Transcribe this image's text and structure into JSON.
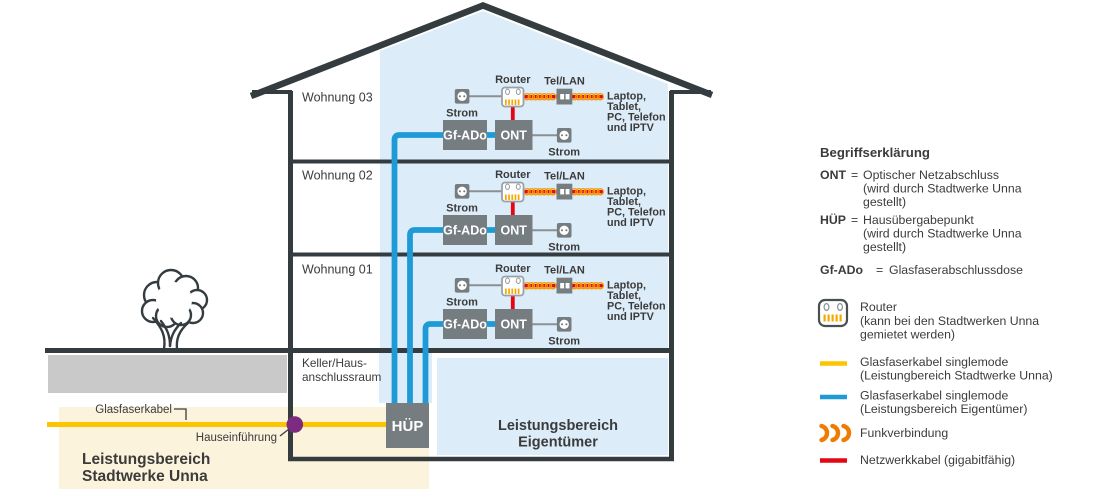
{
  "diagram": {
    "floors": [
      {
        "label": "Wohnung 03"
      },
      {
        "label": "Wohnung 02"
      },
      {
        "label": "Wohnung 01"
      }
    ],
    "basement_label_lines": [
      "Keller/Haus-",
      "anschlussraum"
    ],
    "unit": {
      "router_label": "Router",
      "tel_lan_label": "Tel/LAN",
      "strom_label": "Strom",
      "gfado_label": "Gf-ADo",
      "ont_label": "ONT",
      "device_lines": [
        "Laptop,",
        "Tablet,",
        "PC, Telefon",
        "und IPTV"
      ]
    },
    "huep_label": "HÜP",
    "glasfaserkabel_label": "Glasfaserkabel",
    "hauseinfuehrung_label": "Hauseinführung",
    "zone_stadtwerke_lines": [
      "Leistungsbereich",
      "Stadtwerke Unna"
    ],
    "zone_eigentuemer_lines": [
      "Leistungsbereich",
      "Eigentümer"
    ]
  },
  "legend": {
    "title": "Begriffserklärung",
    "equals_sign": "=",
    "entries": [
      {
        "term": "ONT",
        "lines": [
          "Optischer Netzabschluss",
          "(wird durch Stadtwerke Unna",
          "gestellt)"
        ]
      },
      {
        "term": "HÜP",
        "lines": [
          "Hausübergabepunkt",
          "(wird durch Stadtwerke Unna",
          "gestellt)"
        ]
      },
      {
        "term": "Gf-ADo",
        "lines": [
          "Glasfaserabschlussdose"
        ]
      }
    ],
    "router": {
      "label": "Router",
      "lines": [
        "(kann bei den Stadtwerken Unna",
        "gemietet werden)"
      ]
    },
    "cables": [
      {
        "color": "#fdc400",
        "lines": [
          "Glasfaserkabel singlemode",
          "(Leistungbereich Stadtwerke Unna)"
        ]
      },
      {
        "color": "#1e9bd7",
        "lines": [
          "Glasfaserkabel singlemode",
          "(Leistungsbereich Eigentümer)"
        ]
      },
      {
        "color": "#ef7c00",
        "lines": [
          "Funkverbindung"
        ]
      },
      {
        "color": "#e30613",
        "lines": [
          "Netzwerkkabel (gigabitfähig)"
        ]
      }
    ]
  },
  "colors": {
    "fiber_yellow": "#fdc400",
    "fiber_blue": "#1e9bd7",
    "network_red": "#e30613",
    "funk_orange": "#ef7c00",
    "coil_orange": "#f59b00",
    "box_gray": "#767d80",
    "zone_blue_fill": "#dcecf8",
    "zone_cream_fill": "#fcf3dc",
    "soil_gray": "#c9c9c9",
    "purple": "#7c2b80",
    "zone_text_blue": "#1a9ad6",
    "structure_dark": "#343c40"
  }
}
